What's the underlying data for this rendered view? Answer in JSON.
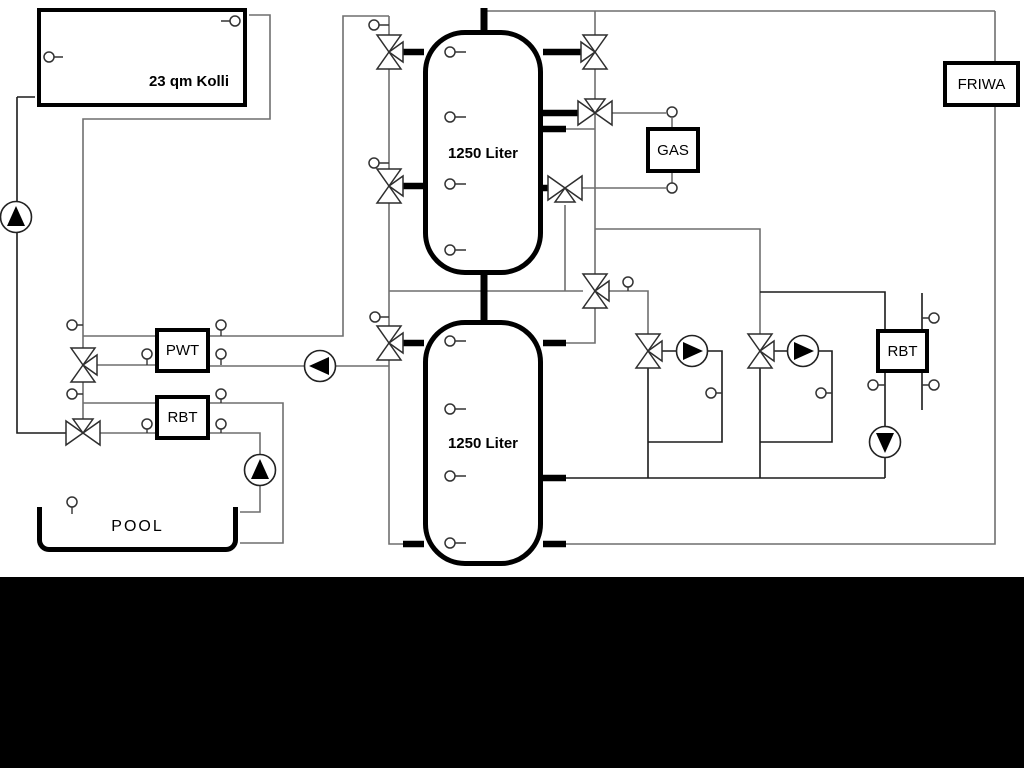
{
  "diagram": {
    "title": "hydraulic-scheme",
    "collector": {
      "label": "23 qm Kolli"
    },
    "tank1": {
      "label": "1250 Liter"
    },
    "tank2": {
      "label": "1250 Liter"
    },
    "gas": {
      "label": "GAS"
    },
    "friwa": {
      "label": "FRIWA"
    },
    "pwt": {
      "label": "PWT"
    },
    "rbt_left": {
      "label": "RBT"
    },
    "rbt_right": {
      "label": "RBT"
    },
    "pool": {
      "label": "POOL"
    },
    "colors": {
      "background": "#ffffff",
      "pipe_gray": "#6f6f6f",
      "pipe_dark": "#1c1c1c",
      "component_outline": "#000000",
      "pump_fill": "#000000",
      "bottom_bar": "#000000"
    }
  }
}
